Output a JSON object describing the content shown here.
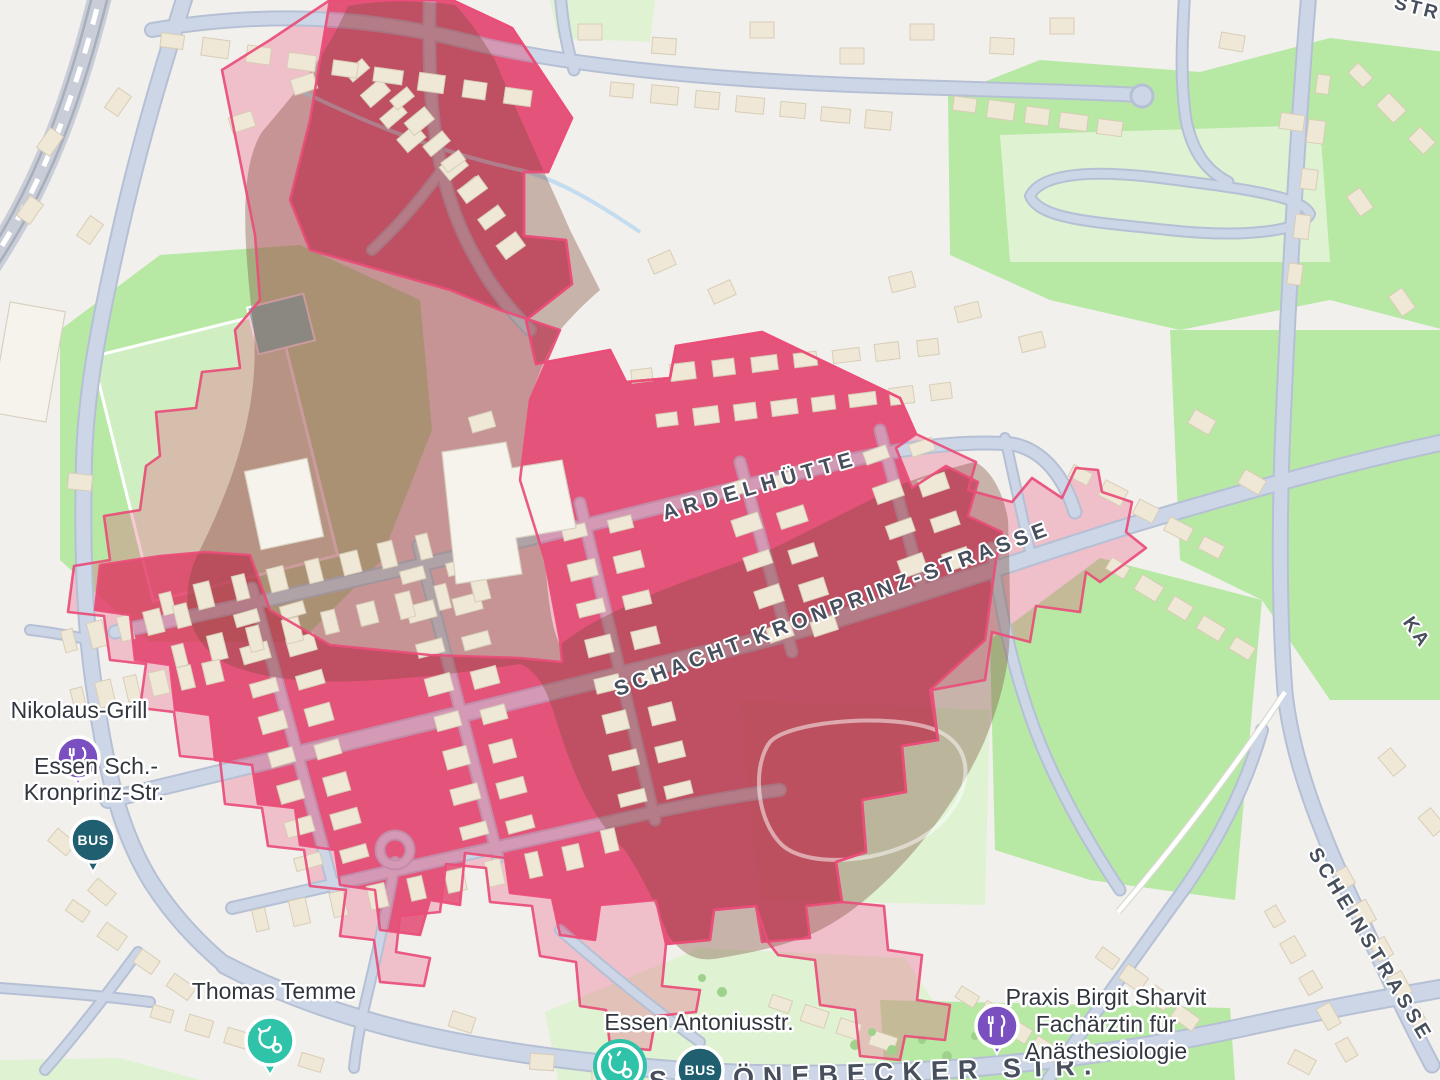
{
  "labels": {
    "streets": {
      "ardelhuette": "ARDELHÜTTE",
      "schacht_kronprinz": "SCHACHT-KRONPRINZ-STRASSE",
      "scheinstrasse": "SCHEINSTRASSE",
      "schoenebecker": "SCHÖNEBECKER STR.",
      "ka_fragment": "KA",
      "str_fragment": "STR"
    },
    "pois": {
      "nikolaus_grill": {
        "label": "Nikolaus-Grill",
        "icon": "restaurant-icon"
      },
      "stop_west": {
        "label_line1": "Essen Sch.-",
        "label_line2": "Kronprinz-Str.",
        "icon": "bus-icon",
        "badge": "BUS"
      },
      "thomas_temme": {
        "label": "Thomas Temme",
        "icon": "stethoscope-icon"
      },
      "stop_south": {
        "label": "Essen Antoniusstr.",
        "icon": "bus-icon",
        "badge": "BUS"
      },
      "doctor_south": {
        "icon": "stethoscope-icon"
      },
      "praxis": {
        "label_line1": "Praxis Birgit Sharvit",
        "label_line2": "Fachärztin für",
        "label_line3": "Anästhesiologie",
        "icon": "restaurant-icon"
      }
    }
  },
  "colors": {
    "zone_border": "#e94d78",
    "zone_fill": "#e8517c",
    "zone_inner_fill": "#e0285a",
    "blob_fill": "#7d4838",
    "restaurant_marker": "#7a4fc0",
    "doctor_marker": "#2fc3aa",
    "bus_marker": "#1f5f70",
    "green_area": "#b7e8a4",
    "green_light": "#dff3d3",
    "road_fill": "#ccd6e7",
    "building_fill": "#efe8d7",
    "land": "#f2f0ec"
  }
}
